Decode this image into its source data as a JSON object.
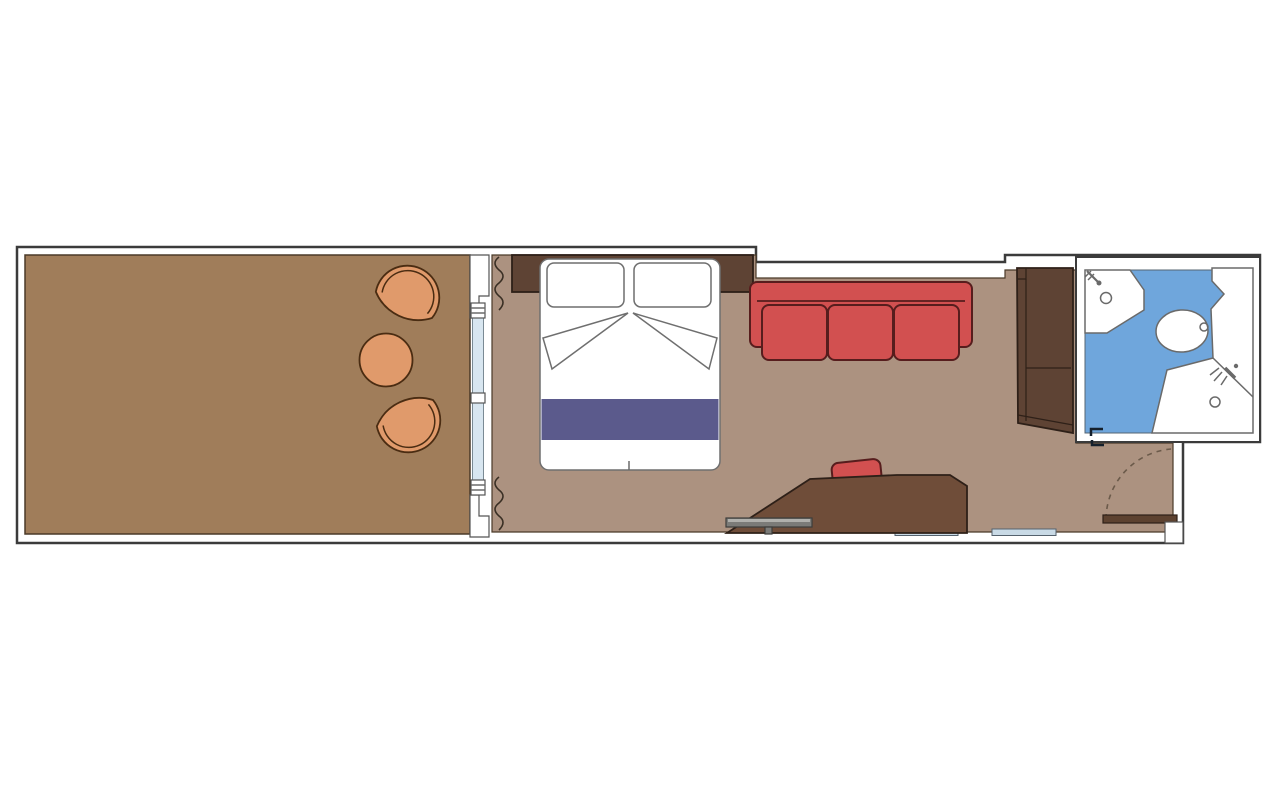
{
  "page": {
    "background": "#ffffff",
    "type": "floor-plan",
    "subject": "Cruise ship suite cabin floor plan with large balcony, bedroom-living area, bathroom and entrance vestibule"
  },
  "colors": {
    "page_bg": "#ffffff",
    "outline": "#3b3b3b",
    "wall_fill": "#ffffff",
    "balcony_floor": "#a07d5a",
    "room_floor": "#ac9280",
    "bathroom_floor": "#6fa6dc",
    "dark_wood": "#5e4334",
    "desk_wood": "#6f4d39",
    "door_wood": "#5d4230",
    "sofa_red": "#d25050",
    "sofa_outline": "#571d1d",
    "patio_orange": "#e09a6b",
    "patio_outline": "#4a2c12",
    "bed_runner_purple": "#5b5a8c",
    "glass_blue": "#d8e6f0",
    "tv_gray": "#7b7b78",
    "wall_strip_blue": "#c9dae6"
  },
  "rooms": [
    {
      "name": "balcony",
      "floor_color": "#a07d5a",
      "items": [
        "armchair",
        "round-table",
        "armchair"
      ]
    },
    {
      "name": "bedroom-living-area",
      "floor_color": "#ac9280",
      "items": [
        "double-bed",
        "headboard-nightstands",
        "sofa",
        "desk-vanity",
        "desk-chair",
        "tv-console",
        "curtains",
        "sliding-glass-door"
      ]
    },
    {
      "name": "bathroom",
      "floor_color": "#6fa6dc",
      "items": [
        "sink-counter",
        "shelf",
        "toilet",
        "shower"
      ]
    },
    {
      "name": "entrance-vestibule",
      "items": [
        "entry-door",
        "door-swing-arc",
        "wardrobe"
      ]
    }
  ],
  "furniture": {
    "bed": {
      "pillows": 2,
      "runner_color": "#5b5a8c"
    },
    "sofa": {
      "cushions": 3,
      "color": "#d25050"
    },
    "balcony_chairs": 2,
    "balcony_table": 1
  }
}
